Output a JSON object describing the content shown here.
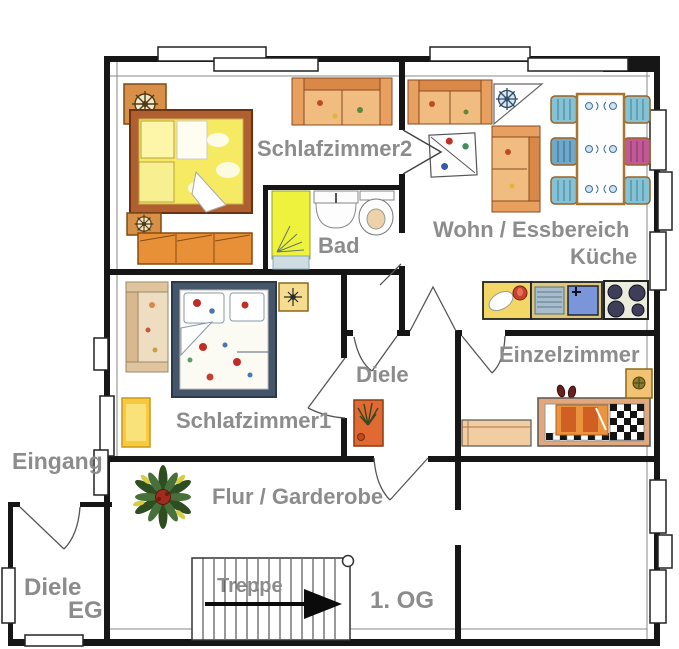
{
  "floorplan": {
    "labels": {
      "schlafzimmer2": "Schlafzimmer2",
      "bad": "Bad",
      "wohn_essbereich": "Wohn / Essbereich",
      "kueche": "Küche",
      "schlafzimmer1": "Schlafzimmer1",
      "diele": "Diele",
      "einzelzimmer": "Einzelzimmer",
      "eingang": "Eingang",
      "flur_garderobe": "Flur / Garderobe",
      "diele_eg_line1": "Diele",
      "diele_eg_line2": "EG",
      "treppe": "Treppe",
      "erste_og": "1. OG"
    },
    "colors": {
      "label_gray": "#8c8c8c",
      "wall_black": "#161616",
      "bed_yellow": "#f6ea62",
      "wood_orange": "#e89038",
      "sofa_peach": "#f0bc80",
      "chair_teal": "#85c2d4",
      "chair_magenta": "#c05a96",
      "shower_yellow": "#eef23c",
      "counter_yellow": "#f2d766",
      "sink_blue": "#7b96d8",
      "duvet_orange": "#eb9440",
      "stairs_arrow": "#0b0b0b"
    },
    "icons": [
      "ship-wheel-icon",
      "compass-rose-icon",
      "plant-icon",
      "stairs-arrow-icon",
      "stove-burners-icon",
      "chess-blanket-icon"
    ]
  }
}
